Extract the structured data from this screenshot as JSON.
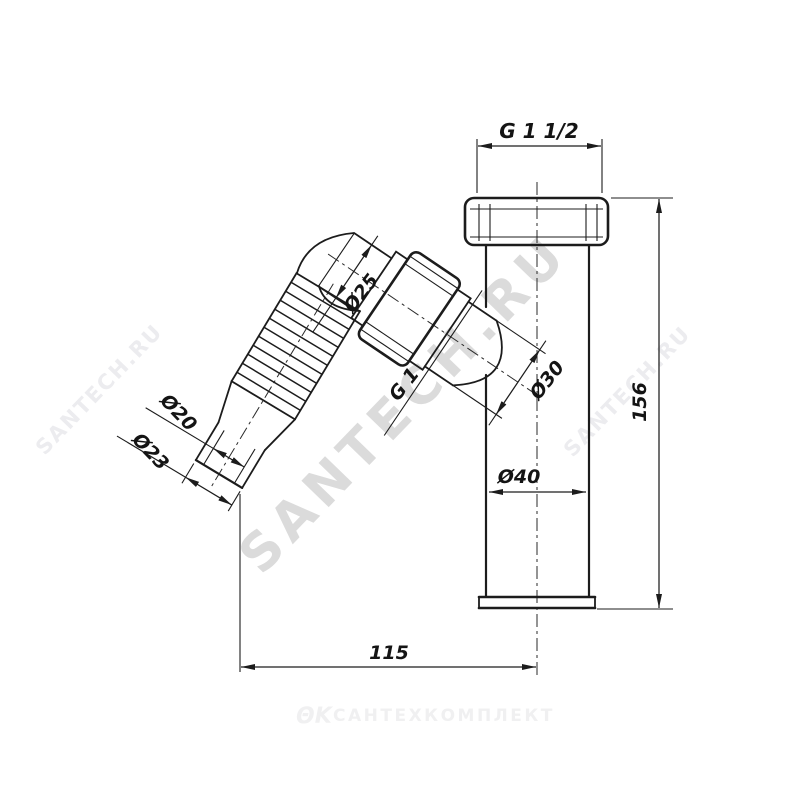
{
  "drawing": {
    "title": "angled-bottle-trap-outlet-pipe-drawing",
    "dimensions": {
      "top_thread": "G 1 1/2",
      "total_height": "156",
      "total_width": "115",
      "pipe_diameter": "Ø40",
      "branch_outer_diameter": "Ø30",
      "elbow_diameter": "Ø25",
      "union_thread": "G 1",
      "inlet_inner_diameter": "Ø20",
      "inlet_outer_diameter": "Ø23"
    },
    "watermarks": {
      "large_diagonal": "SANTECH.RU",
      "small_diagonal_left": "SANTECH.RU",
      "small_diagonal_right": "SANTECH.RU",
      "footer_logo": "ΘΚ",
      "footer_brand": "САНТЕХКОМПЛЕКТ"
    },
    "colors": {
      "line": "#1c1c1c",
      "background": "#ffffff",
      "watermark_large": "#dbdbdb",
      "watermark_small": "#ececef",
      "watermark_footer": "#f0f0f1"
    }
  }
}
